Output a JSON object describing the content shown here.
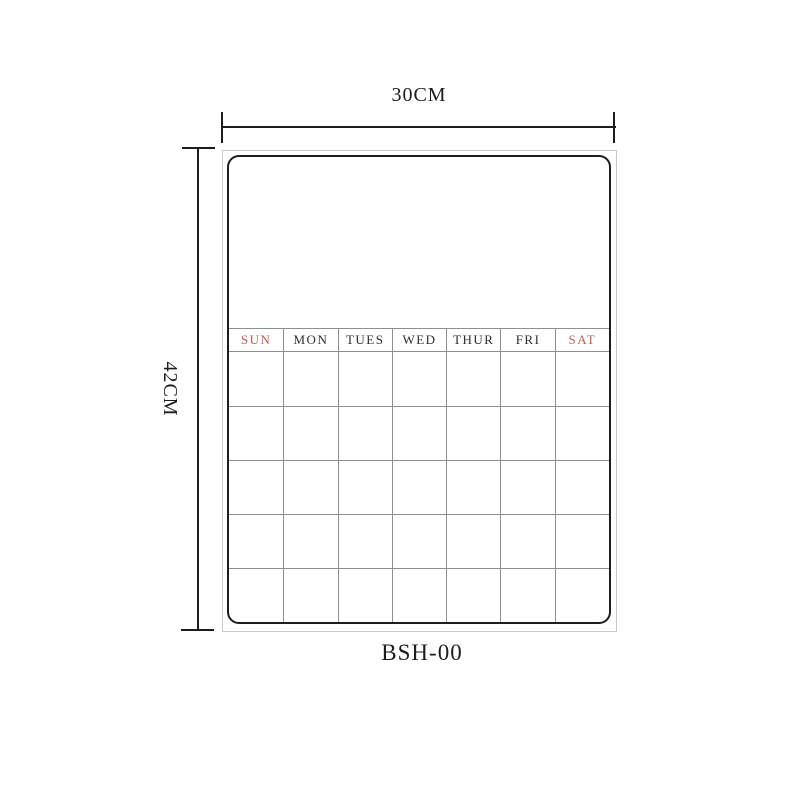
{
  "colors": {
    "ink": "#1d1d1d",
    "weekend_red": "#c85b52",
    "weekday_ink": "#2e2e2e",
    "grid_line": "#8f8f8f",
    "board_edge": "#c9c9c9"
  },
  "dimensions": {
    "width_label": "30CM",
    "height_label": "42CM"
  },
  "model_label": "BSH-00",
  "board": {
    "day_headers": [
      {
        "label": "SUN",
        "weekend": true
      },
      {
        "label": "MON",
        "weekend": false
      },
      {
        "label": "TUES",
        "weekend": false
      },
      {
        "label": "WED",
        "weekend": false
      },
      {
        "label": "THUR",
        "weekend": false
      },
      {
        "label": "FRI",
        "weekend": false
      },
      {
        "label": "SAT",
        "weekend": true
      }
    ],
    "grid": {
      "rows": 5,
      "columns": 7
    }
  }
}
